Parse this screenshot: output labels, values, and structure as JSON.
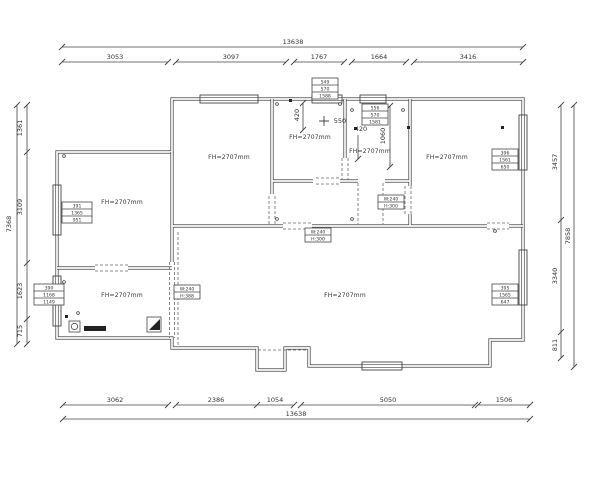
{
  "drawing": {
    "rooms": [
      {
        "label": "FH=2707mm"
      },
      {
        "label": "FH=2707mm"
      },
      {
        "label": "FH=2707mm"
      },
      {
        "label": "FH=2707mm"
      },
      {
        "label": "FH=2707mm"
      },
      {
        "label": "FH=2707mm"
      },
      {
        "label": "FH=2707mm"
      }
    ],
    "dimensions": {
      "top": {
        "total": "13638",
        "segments": [
          "3053",
          "3097",
          "1767",
          "1664",
          "3416"
        ]
      },
      "bottom": {
        "total": "13638",
        "segments": [
          "3062",
          "2386",
          "1054",
          "5050",
          "1506"
        ]
      },
      "left": {
        "total": "7368",
        "segments": [
          "1361",
          "3109",
          "1623",
          "715"
        ]
      },
      "right": {
        "total": "7858",
        "segments": [
          "3457",
          "3340",
          "811"
        ]
      }
    },
    "inline_dims": [
      "420",
      "550",
      "420",
      "1060"
    ],
    "dim_boxes": [
      {
        "rows": [
          "549",
          "570",
          "1588"
        ]
      },
      {
        "rows": [
          "556",
          "570",
          "1581"
        ]
      },
      {
        "rows": [
          "391",
          "1365",
          "951"
        ]
      },
      {
        "rows": [
          "396",
          "1561",
          "650"
        ]
      },
      {
        "rows": [
          "395",
          "1565",
          "647"
        ]
      },
      {
        "rows": [
          "390",
          "1168",
          "1149"
        ]
      }
    ],
    "beam_boxes": [
      {
        "rows": [
          "W:240",
          "H:300"
        ]
      },
      {
        "rows": [
          "W:240",
          "H:300"
        ]
      },
      {
        "rows": [
          "W:240",
          "H:388"
        ]
      }
    ]
  },
  "colors": {
    "line": "#444444",
    "text": "#333333",
    "background": "#ffffff"
  }
}
